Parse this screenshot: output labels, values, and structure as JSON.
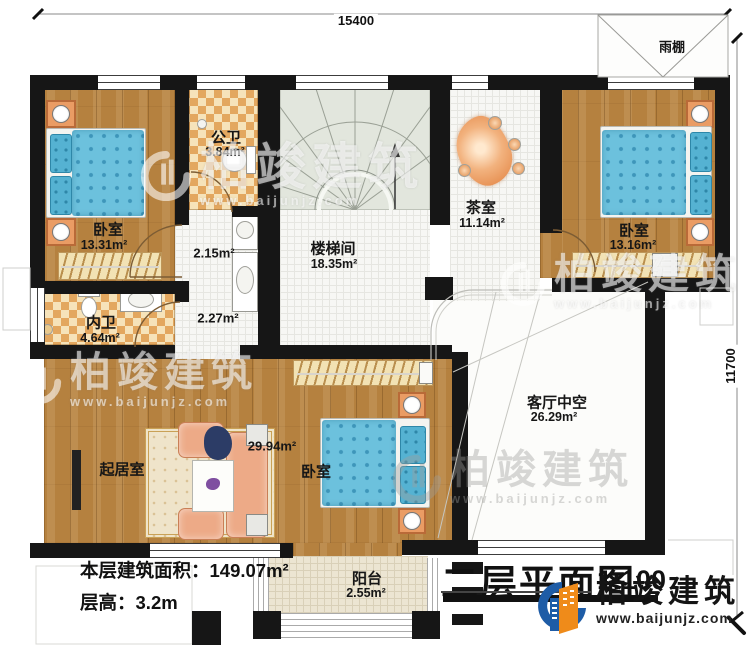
{
  "meta": {
    "title": "二层平面图",
    "scale": "1:100",
    "floor_area_label": "本层建筑面积：",
    "floor_area_value": "149.07m²",
    "floor_height_label": "层高：",
    "floor_height_value": "3.2m"
  },
  "dimensions": {
    "top": "15400",
    "right": "11700"
  },
  "rooms": {
    "bedroom1": {
      "name": "卧室",
      "area": "13.31m²"
    },
    "public_bath": {
      "name": "公卫",
      "area": "3.84m²"
    },
    "stair_hall": {
      "name": "楼梯间",
      "area": "18.35m²"
    },
    "tea_room": {
      "name": "茶室",
      "area": "11.14m²"
    },
    "bedroom2": {
      "name": "卧室",
      "area": "13.16m²"
    },
    "private_bath": {
      "name": "内卫",
      "area": "4.64m²"
    },
    "hall_a": {
      "area": "2.15m²"
    },
    "hall_b": {
      "area": "2.27m²"
    },
    "living": {
      "name": "起居室"
    },
    "bedroom3": {
      "name": "卧室",
      "area": "29.94m²"
    },
    "void": {
      "name": "客厅中空",
      "area": "26.29m²"
    },
    "balcony": {
      "name": "阳台",
      "area": "2.55m²"
    },
    "canopy": {
      "name": "雨棚"
    }
  },
  "branding": {
    "logo_text": "柏竣建筑",
    "logo_url": "www.baijunjz.com",
    "watermark_text": "柏竣建筑",
    "watermark_url": "www.baijunjz.com"
  },
  "colors": {
    "wall": "#161616",
    "wood": "#b5813f",
    "tile_checker": "#e3a75f",
    "bed_blue": "#6cc1dd",
    "nightstand": "#ea9c64",
    "stair": "#e2e6dd",
    "logo_blue": "#1e5ca6",
    "logo_orange": "#ef8b1a"
  }
}
